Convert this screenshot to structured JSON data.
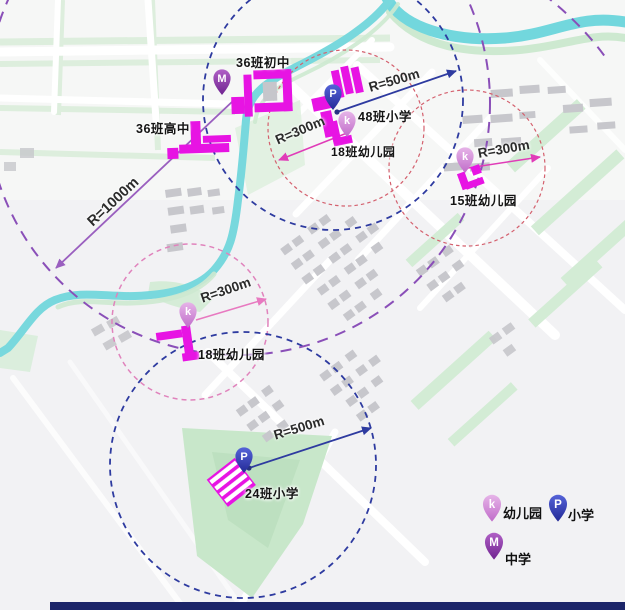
{
  "map_title": "学校服务半径规划图",
  "schools": {
    "junior_high": {
      "name": "36班初中",
      "marker": "M",
      "type": "中学"
    },
    "senior_high": {
      "name": "36班高中",
      "type": "中学"
    },
    "primary_48": {
      "name": "48班小学",
      "marker": "P",
      "type": "小学"
    },
    "kg_18_north": {
      "name": "18班幼儿园",
      "marker": "k",
      "type": "幼儿园"
    },
    "kg_15": {
      "name": "15班幼儿园",
      "marker": "k",
      "type": "幼儿园"
    },
    "kg_18_west": {
      "name": "18班幼儿园",
      "marker": "k",
      "type": "幼儿园"
    },
    "primary_24": {
      "name": "24班小学",
      "marker": "P",
      "type": "小学"
    }
  },
  "radius_labels": {
    "r1000_senior_high": "R=1000m",
    "r500_primary_48": "R=500m",
    "r300_kg_18_north": "R=300m",
    "r300_kg_15": "R=300m",
    "r300_kg_18_west": "R=300m",
    "r500_primary_24": "R=500m"
  },
  "legend": {
    "items": [
      {
        "letter": "k",
        "label": "幼儿园"
      },
      {
        "letter": "P",
        "label": "小学"
      },
      {
        "letter": "M",
        "label": "中学"
      }
    ]
  },
  "colors": {
    "school_building_magenta": "#e714e3",
    "kindergarten_pin": "#cf86d6",
    "primary_pin": "#3a46c8",
    "middle_pin": "#93159b",
    "arrow_r300_magenta": "#e03cb8",
    "arrow_r500_blue": "#2e3ba0",
    "arrow_r1000_purple": "#9a5fbf",
    "circle_r300_red": "#d4606e",
    "circle_r300_pink": "#e083bc",
    "circle_r500_blue": "#2e3ba0",
    "circle_r1000_purple": "#8a4fb8",
    "water": "#72d7dd",
    "green_space": "#cbe8cc",
    "bottom_bar": "#1c2569"
  }
}
